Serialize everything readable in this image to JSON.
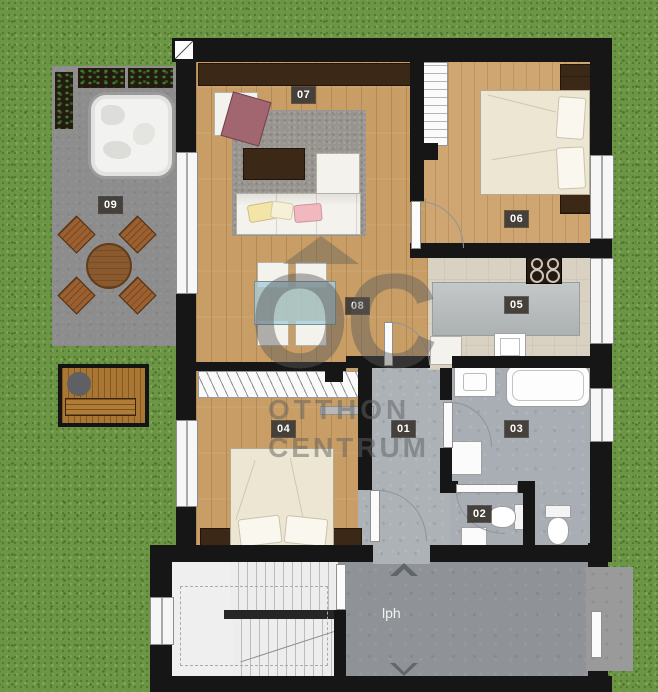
{
  "plan": {
    "type": "apartment-floor-plan",
    "corridor_label": "lph",
    "rooms": {
      "r01": {
        "label": "01",
        "name": "hallway"
      },
      "r02": {
        "label": "02",
        "name": "wc"
      },
      "r03": {
        "label": "03",
        "name": "bathroom"
      },
      "r04": {
        "label": "04",
        "name": "bedroom"
      },
      "r05": {
        "label": "05",
        "name": "kitchen"
      },
      "r06": {
        "label": "06",
        "name": "bedroom"
      },
      "r07": {
        "label": "07",
        "name": "living-room"
      },
      "r08": {
        "label": "08",
        "name": "dining-area"
      },
      "r09": {
        "label": "09",
        "name": "terrace"
      }
    }
  },
  "watermark": {
    "letters": "OC",
    "line1": "OTTHON",
    "line2": "CENTRUM"
  },
  "colors": {
    "grass": "#6d9546",
    "wall": "#161616",
    "wood_floor": "#c89e66",
    "terrace": "#8d8d8d",
    "bath_tile": "#a9aeb4",
    "kitchen_tile": "#d9d1c2",
    "label_bg": "#45403a",
    "accent_armchair": "#a26671",
    "accent_pillow_pink": "#f2b8c0",
    "accent_pillow_yellow": "#f3e4a8"
  }
}
